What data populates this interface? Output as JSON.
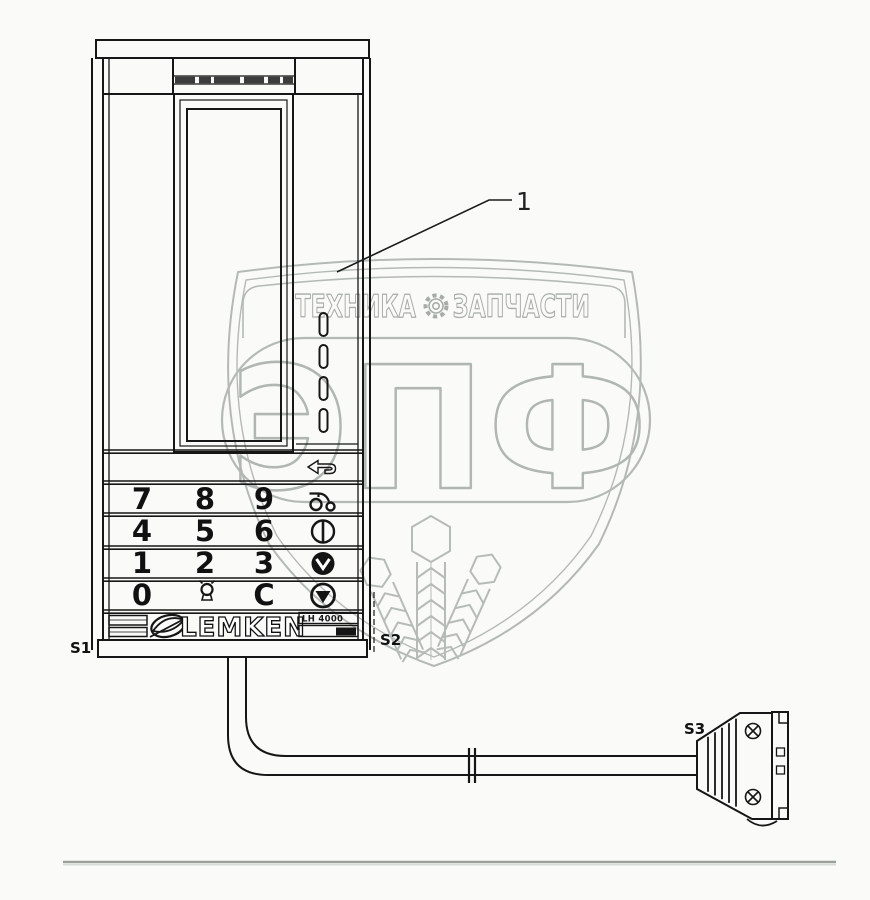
{
  "callouts": {
    "part": "1",
    "s1": "S1",
    "s2": "S2",
    "s3": "S3"
  },
  "terminal": {
    "brand": "LEMKEN",
    "model_label": "LH 4000",
    "keypad": {
      "row1": [
        "7",
        "8",
        "9"
      ],
      "row2": [
        "4",
        "5",
        "6"
      ],
      "row3": [
        "1",
        "2",
        "3"
      ],
      "row4_zero": "0",
      "row4_clear": "C"
    },
    "icons": {
      "row1": "tractor-icon",
      "row2": "contrast-circle-icon",
      "row3": "filled-circle-chevron-down-icon",
      "row4": "circle-triangle-down-icon",
      "row4_middle": "lamp-icon",
      "above_keypad": "return-arrow-icon"
    }
  },
  "watermark": {
    "text_left": "ТЕХНИКА",
    "text_right": "ЗАПЧАСТИ",
    "monogram": "ЭПФ",
    "gear": "gear-icon"
  },
  "colors": {
    "ink": "#161616",
    "watermark_line": "#b5b9b5",
    "watermark_text": "#a8aca8",
    "background": "#fafbf8",
    "bottom_rule": "#9aa09a"
  }
}
